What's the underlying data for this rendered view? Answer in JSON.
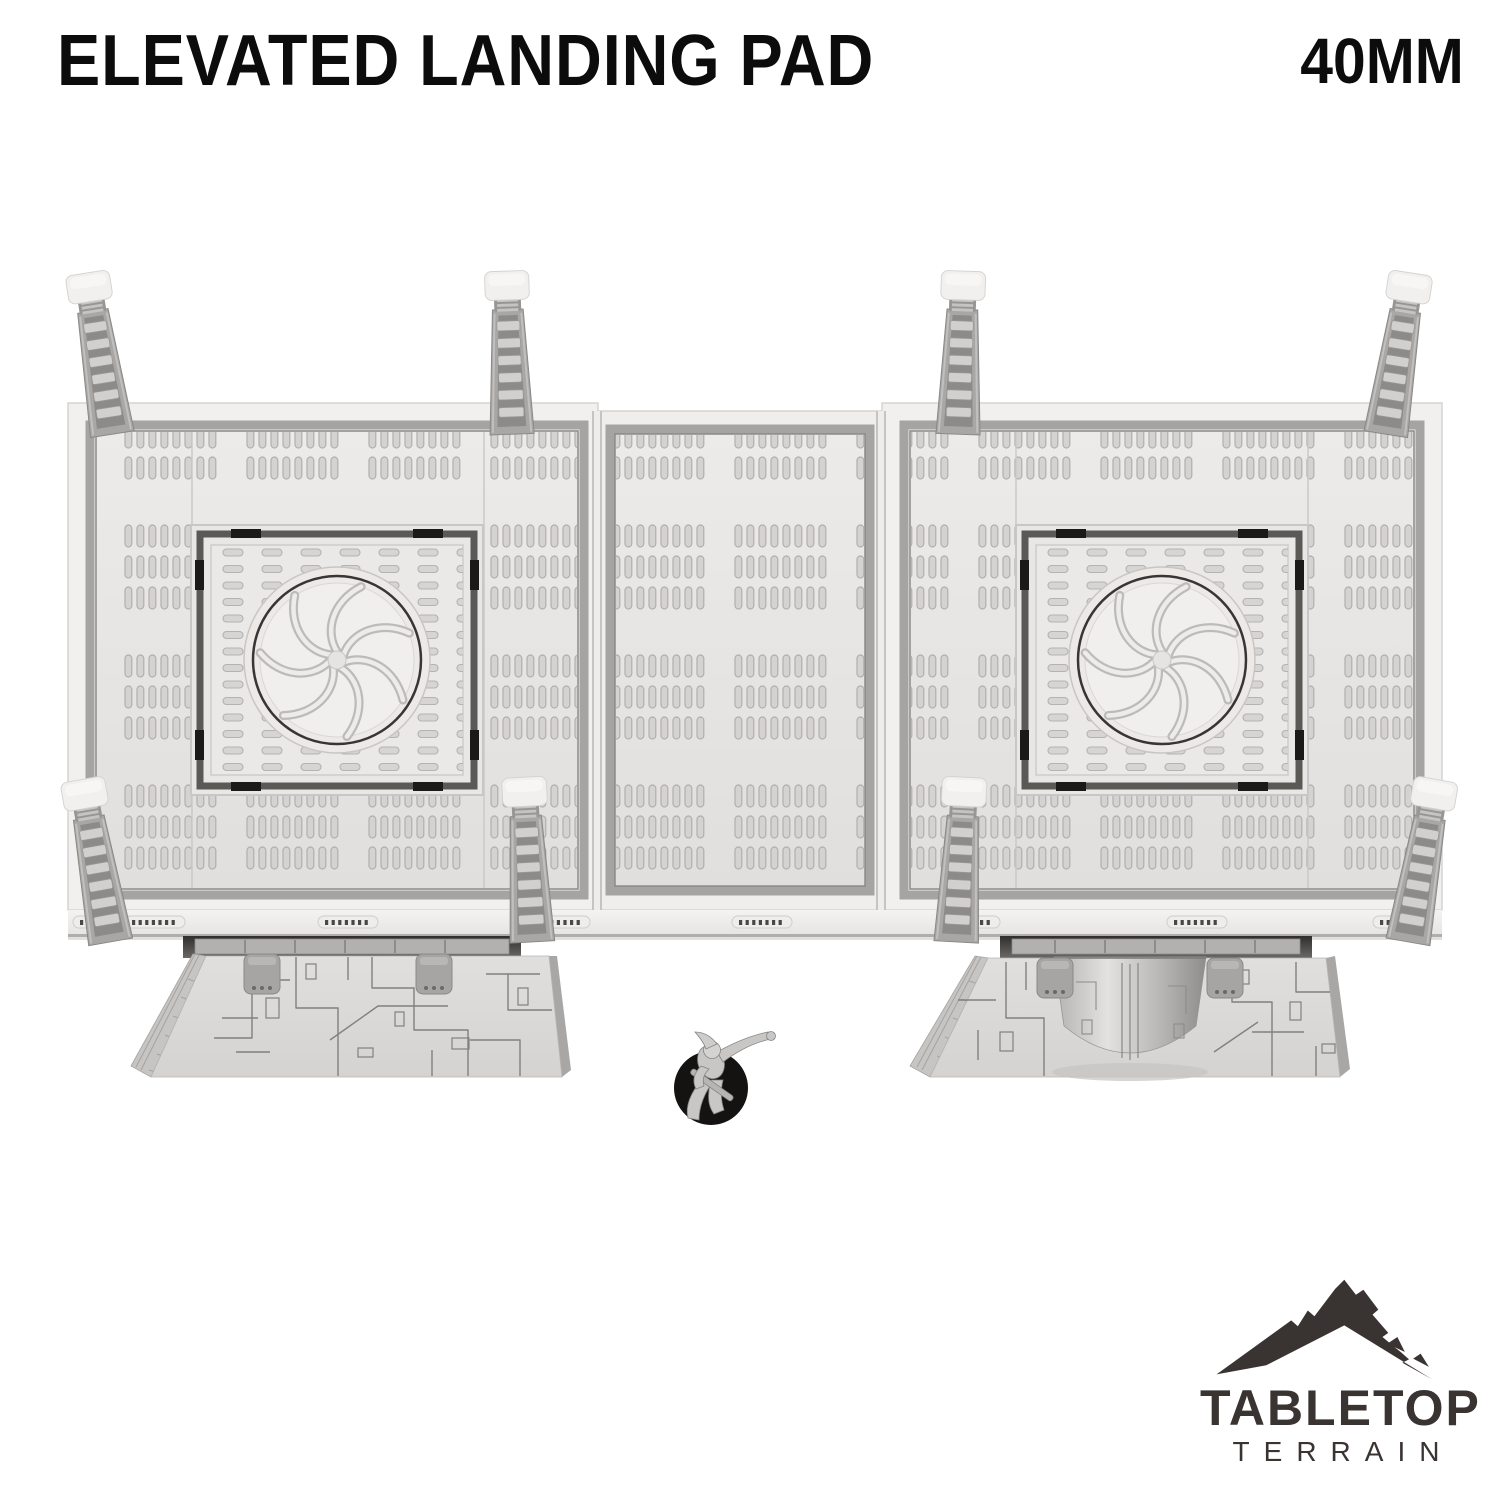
{
  "header": {
    "title": "ELEVATED LANDING PAD",
    "scale": "40MM"
  },
  "brand": {
    "name_top": "TABLETOP",
    "name_bottom": "TERRAIN"
  },
  "render": {
    "alt": "Top-down render of an elevated landing pad: two square fan vents in perforated deck plating, eight ladders, two greebled support pillars, and a miniature on a round black base for scale"
  },
  "colors": {
    "background": "#ffffff",
    "text": "#0c0c0c",
    "brand": "#393331",
    "deck_light": "#eceae8",
    "deck_slot": "#d5d3d1",
    "channel_gray": "#a6a4a2",
    "ladder_gray": "#a9a7a5",
    "recess_dark": "#3f3d3b",
    "fan_ring": "#383634",
    "mini_base": "#141312"
  }
}
